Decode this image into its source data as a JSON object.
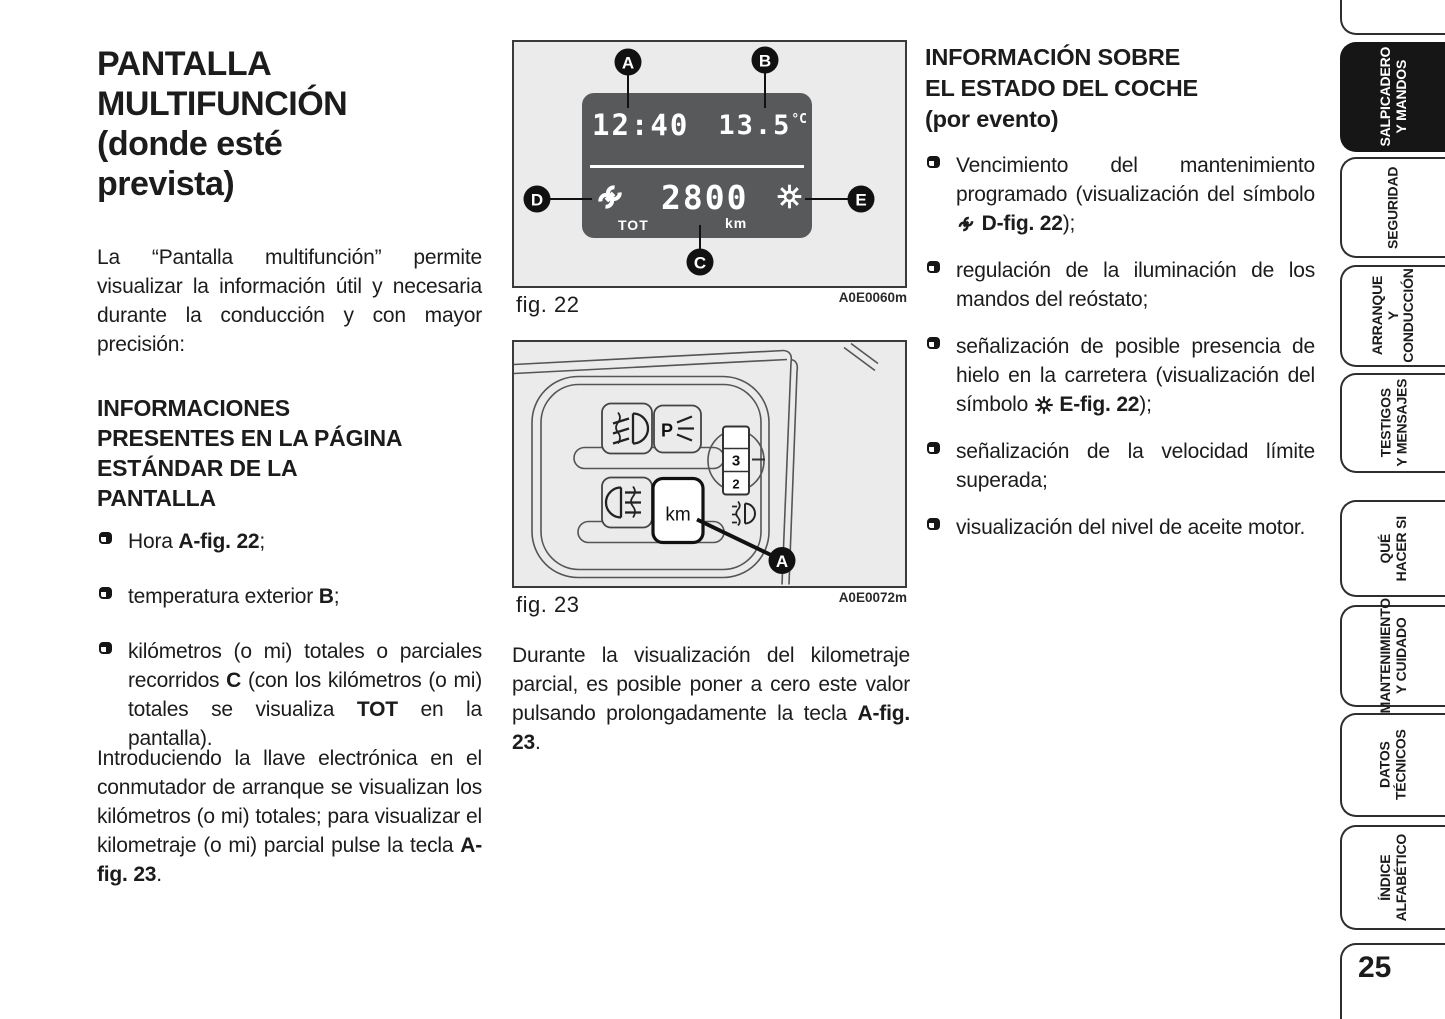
{
  "colors": {
    "text": "#1c1c1c",
    "figure-bg": "#ebebeb",
    "figure-border": "#3a3a3a",
    "display-bg": "#58595b",
    "display-fg": "#ffffff",
    "tab-active-bg": "#161616",
    "tab-active-fg": "#ffffff",
    "tab-border": "#2e2e2e"
  },
  "left_column": {
    "title": "PANTALLA\nMULTIFUNCIÓN\n(donde esté\nprevista)",
    "intro": "La “Pantalla multifunción” permite visualizar la información útil y necesaria durante la conducción y con mayor precisión:",
    "section_heading": "INFORMACIONES\nPRESENTES EN LA PÁGINA\nESTÁNDAR DE LA\nPANTALLA",
    "bullets": [
      [
        {
          "t": "Hora "
        },
        {
          "t": "A-fig. 22",
          "b": true
        },
        {
          "t": ";"
        }
      ],
      [
        {
          "t": "temperatura exterior "
        },
        {
          "t": "B",
          "b": true
        },
        {
          "t": ";"
        }
      ],
      [
        {
          "t": "kilómetros (o mi) totales o parciales recorridos "
        },
        {
          "t": "C",
          "b": true
        },
        {
          "t": " (con los kilómetros (o mi) totales se visualiza "
        },
        {
          "t": "TOT",
          "b": true
        },
        {
          "t": " en la pantalla)."
        }
      ]
    ],
    "closing": [
      {
        "t": "Introduciendo la llave electrónica en el conmutador de arranque se visualizan los kilómetros (o mi) totales; para visualizar el kilometraje (o mi) parcial pulse la tecla "
      },
      {
        "t": "A-fig. 23",
        "b": true
      },
      {
        "t": "."
      }
    ]
  },
  "middle_column": {
    "fig22": {
      "caption": "fig. 22",
      "code": "A0E0060m",
      "callouts": [
        "A",
        "B",
        "C",
        "D",
        "E"
      ],
      "display": {
        "time": "12:40",
        "temp": "13.5",
        "temp_unit": "°C",
        "odometer": "2800",
        "odometer_unit": "km",
        "tot_label": "TOT"
      }
    },
    "fig23": {
      "caption": "fig. 23",
      "code": "A0E0072m",
      "callout": "A",
      "km_button": "km",
      "position_light_letter": "P",
      "dial_numbers": [
        "3",
        "2"
      ]
    },
    "paragraph": [
      {
        "t": "Durante la visualización del kilometraje parcial, es posible poner a cero este valor pulsando prolongadamente la tecla "
      },
      {
        "t": "A-fig. 23",
        "b": true
      },
      {
        "t": "."
      }
    ]
  },
  "right_column": {
    "heading": "INFORMACIÓN SOBRE\nEL ESTADO DEL COCHE\n(por evento)",
    "bullets": [
      [
        {
          "t": "Vencimiento del mantenimiento programado (visualización del símbolo "
        },
        {
          "icon": "wrench-icon"
        },
        {
          "t": " "
        },
        {
          "t": "D-fig. 22",
          "b": true
        },
        {
          "t": ");"
        }
      ],
      [
        {
          "t": "regulación de la iluminación de los mandos del reóstato;"
        }
      ],
      [
        {
          "t": "señalización de posible presencia de hielo en la carretera (visualización del símbolo "
        },
        {
          "icon": "snowflake-icon"
        },
        {
          "t": " "
        },
        {
          "t": "E-fig. 22",
          "b": true
        },
        {
          "t": ");"
        }
      ],
      [
        {
          "t": "señalización de la velocidad límite superada;"
        }
      ],
      [
        {
          "t": "visualización del nivel de aceite motor."
        }
      ]
    ]
  },
  "sidebar": {
    "tabs": [
      {
        "label": "SALPICADERO\nY MANDOS",
        "active": true
      },
      {
        "label": "SEGURIDAD",
        "active": false
      },
      {
        "label": "ARRANQUE\nY CONDUCCIÓN",
        "active": false
      },
      {
        "label": "TESTIGOS\nY MENSAJES",
        "active": false
      },
      {
        "label": "QUÉ\nHACER SI",
        "active": false
      },
      {
        "label": "MANTENIMIENTO\nY CUIDADO",
        "active": false
      },
      {
        "label": "DATOS\nTÉCNICOS",
        "active": false
      },
      {
        "label": "ÍNDICE\nALFABÉTICO",
        "active": false
      }
    ],
    "page_number": "25"
  }
}
